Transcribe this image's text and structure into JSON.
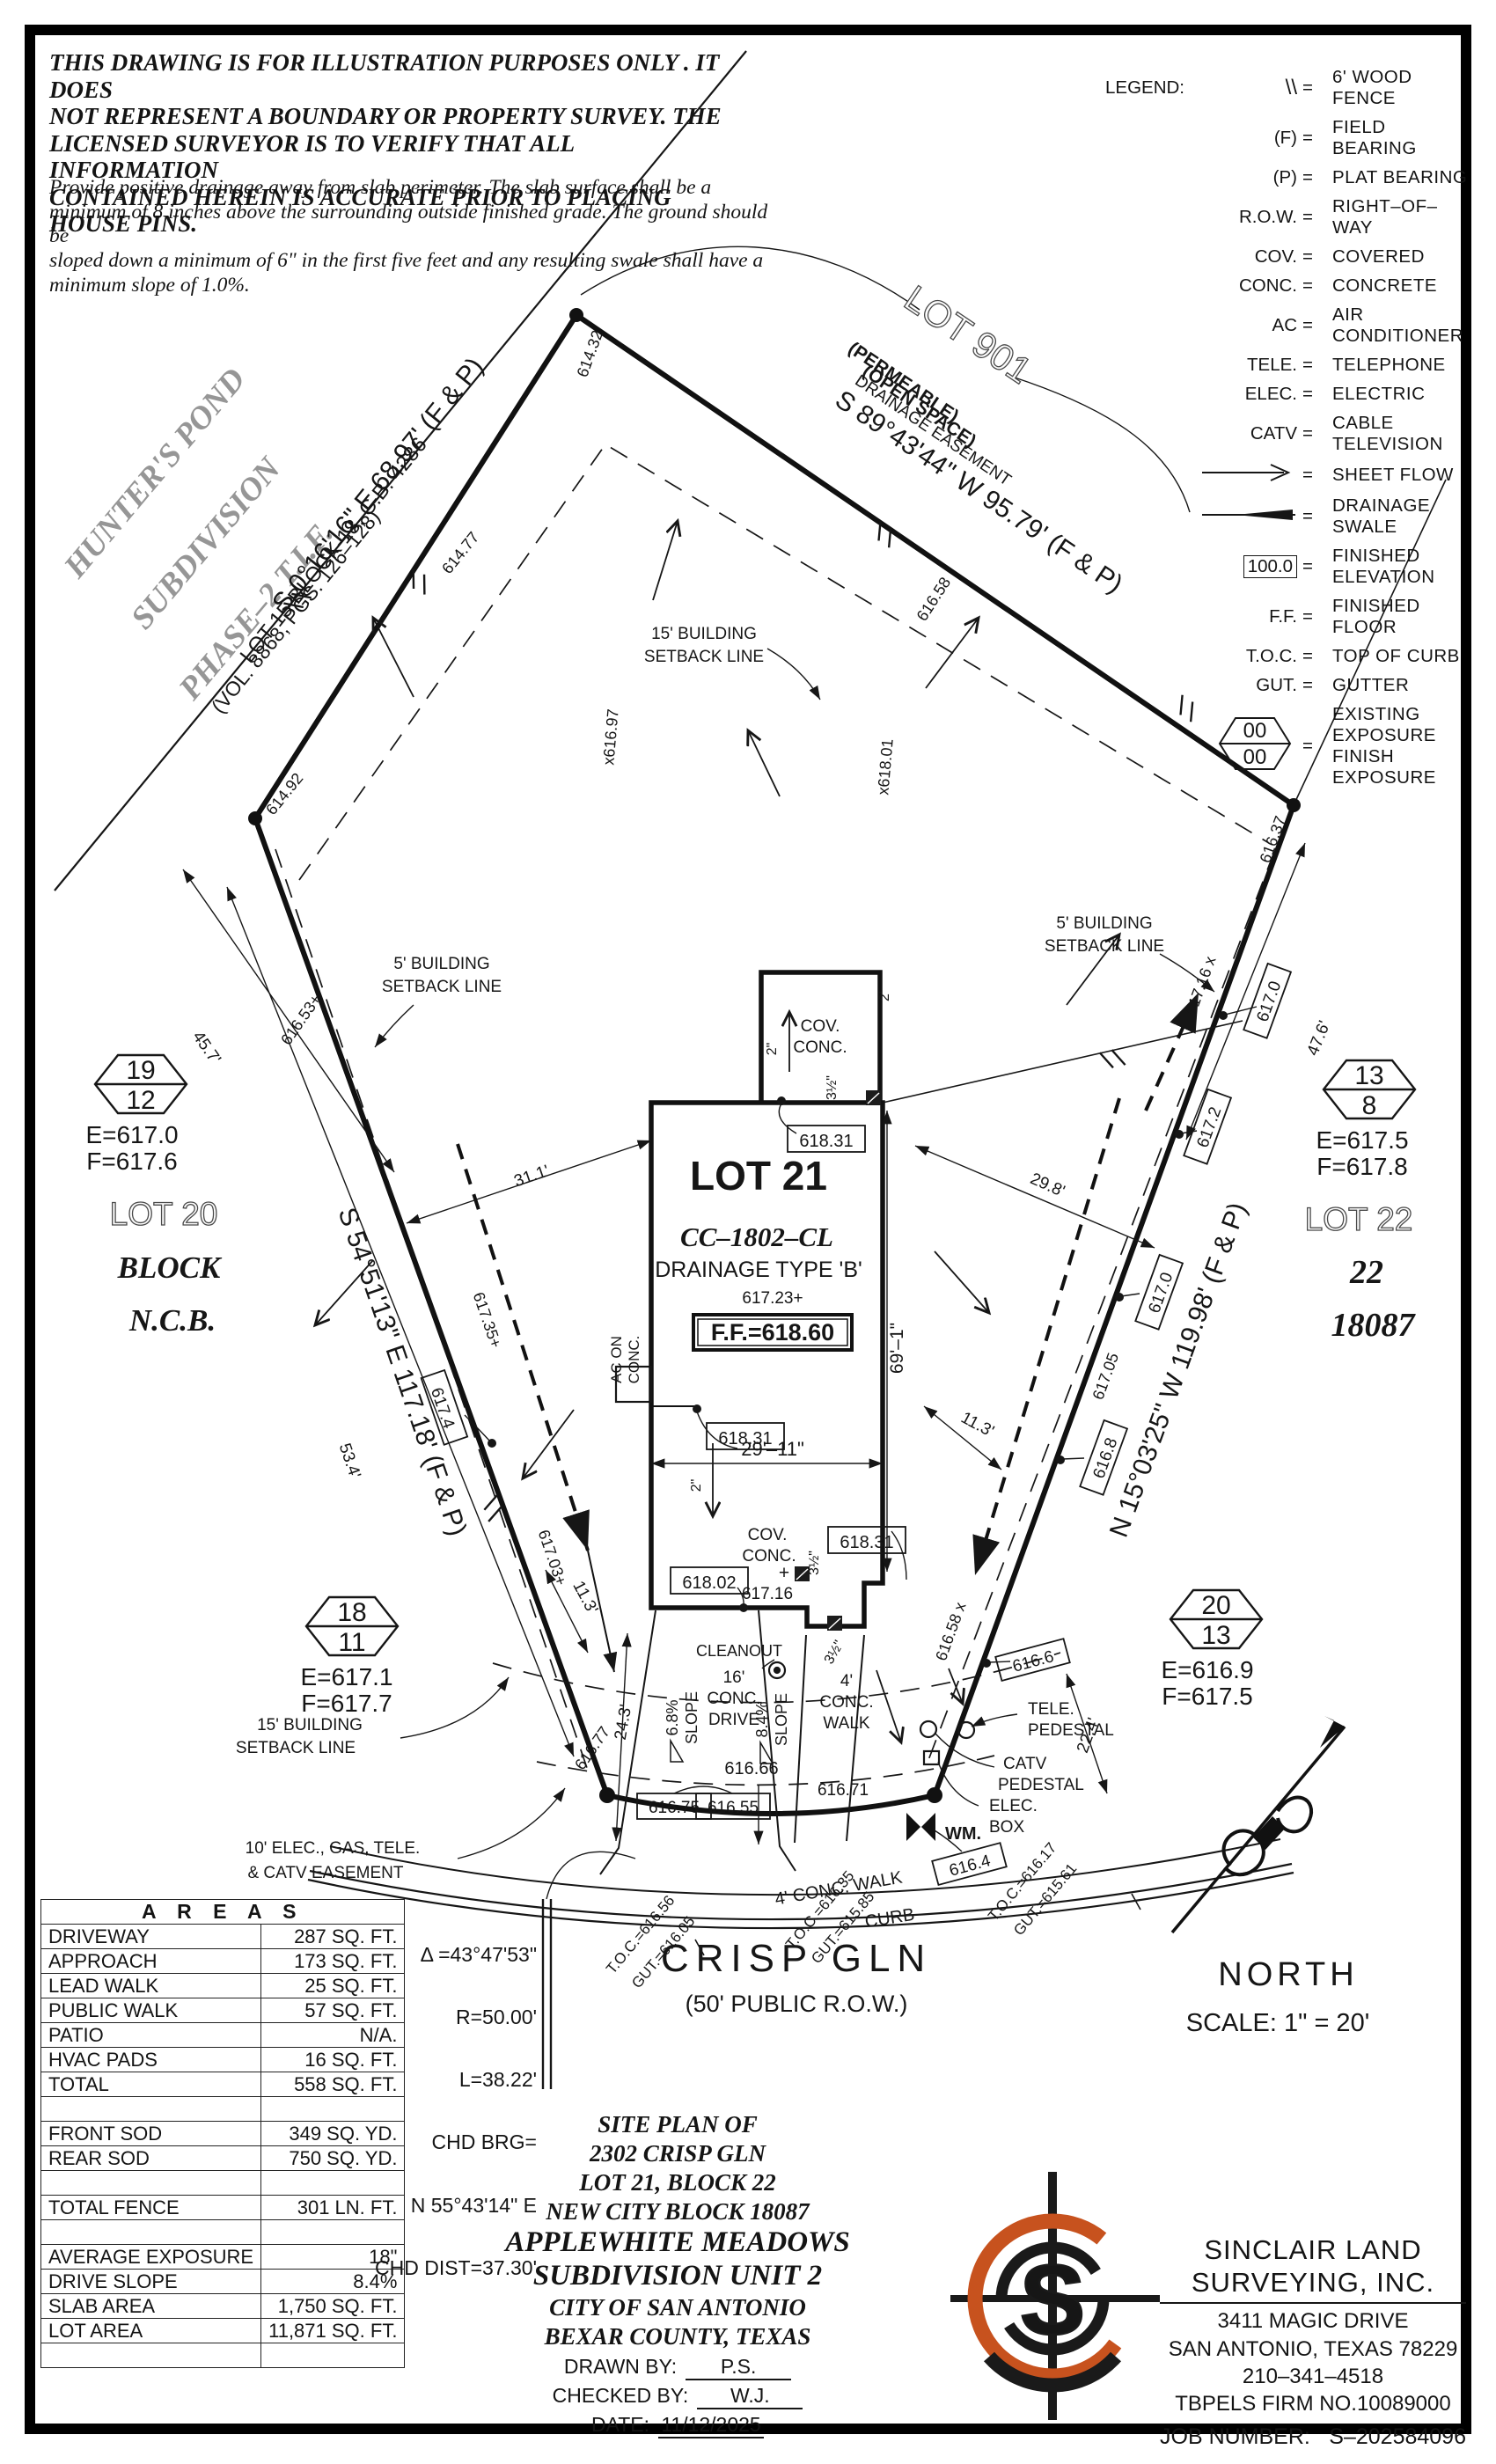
{
  "disclaimer": {
    "p1": "THIS DRAWING IS FOR ILLUSTRATION PURPOSES ONLY . IT DOES\nNOT REPRESENT A BOUNDARY OR PROPERTY SURVEY. THE\nLICENSED SURVEYOR IS TO VERIFY THAT ALL INFORMATION\nCONTAINED HEREIN IS ACCURATE PRIOR TO PLACING HOUSE PINS.",
    "p2": "Provide positive drainage away from slab perimeter. The slab surface shall be a\nminimum of 8 inches above the surrounding outside finished grade. The ground should be\nsloped down a minimum of 6\" in the first five feet and any resulting swale shall have a\nminimum slope of 1.0%."
  },
  "legend": {
    "title": "LEGEND:",
    "eq": "=",
    "fence_sym": "\\\\",
    "fence": "6' WOOD FENCE",
    "f_sym": "(F)",
    "f": "FIELD BEARING",
    "p_sym": "(P)",
    "p": "PLAT BEARING",
    "row_sym": "R.O.W.",
    "row": "RIGHT–OF–WAY",
    "cov_sym": "COV.",
    "cov": "COVERED",
    "conc_sym": "CONC.",
    "conc": "CONCRETE",
    "ac_sym": "AC",
    "ac": "AIR CONDITIONER",
    "tele_sym": "TELE.",
    "tele": "TELEPHONE",
    "elec_sym": "ELEC.",
    "elec": "ELECTRIC",
    "catv_sym": "CATV",
    "catv": "CABLE TELEVISION",
    "sheet": "SHEET FLOW",
    "swale": "DRAINAGE SWALE",
    "elev_val": "100.0",
    "elev": "FINISHED ELEVATION",
    "ff_sym": "F.F.",
    "ff": "FINISHED FLOOR",
    "toc_sym": "T.O.C.",
    "toc": "TOP OF CURB",
    "gut_sym": "GUT.",
    "gut": "GUTTER",
    "exp_top": "00",
    "exp_bot": "00",
    "exp1": "EXISTING EXPOSURE",
    "exp2": "FINISH EXPOSURE"
  },
  "survey": {
    "adjacent": {
      "hp1": "HUNTER'S POND",
      "hp2": "SUBDIVISION",
      "hp3": "PHASE–2 T.I.F.",
      "vol": "(VOL. 8868, PGS. 126–128)",
      "lot15": "LOT 15 BLOCK 18, C.B. 4286"
    },
    "lot901": {
      "name": "LOT 901",
      "permeable": "(PERMEABLE)",
      "open": "(OPEN SPACE)",
      "drain": "DRAINAGE EASEMENT"
    },
    "bearings": {
      "tl": "S 0°16'16\" E 68.97' (F & P)",
      "tr": "S 89°43'44\" W 95.79' (F & P)",
      "left": "S 54°51'13\" E 117.18' (F & P)",
      "right": "N 15°03'25\" W 119.98' (F & P)"
    },
    "lots": {
      "lot20": "LOT 20",
      "block": "BLOCK",
      "ncb": "N.C.B.",
      "lot21": "LOT 21",
      "cc": "CC–1802–CL",
      "dtype": "DRAINAGE TYPE 'B'",
      "pad": "617.23+",
      "ff": "F.F.=618.60",
      "lot22": "LOT 22",
      "n22": "22",
      "nblock": "18087"
    },
    "hexes": [
      {
        "t": "19",
        "b": "12",
        "e": "E=617.0",
        "f": "F=617.6"
      },
      {
        "t": "18",
        "b": "11",
        "e": "E=617.1",
        "f": "F=617.7"
      },
      {
        "t": "13",
        "b": "8",
        "e": "E=617.5",
        "f": "F=617.8"
      },
      {
        "t": "20",
        "b": "13",
        "e": "E=616.9",
        "f": "F=617.5"
      }
    ],
    "setback": {
      "l15a": "15' BUILDING",
      "l15b": "SETBACK LINE",
      "l5a": "5' BUILDING",
      "l5b": "SETBACK LINE"
    },
    "easement": {
      "l1": "10' ELEC., GAS, TELE.",
      "l2": "& CATV EASEMENT"
    },
    "spots": {
      "v1": "614.32",
      "v2": "614.92",
      "v3": "616.37",
      "v4": "616.77",
      "v5": "616.71",
      "e614_77": "614.77",
      "e616_53": "616.53+",
      "e616_58t": "616.58",
      "e616_97": "x616.97",
      "e618_01": "x618.01",
      "e617_35": "617.35+",
      "e617_03": "617.03+",
      "e617_16x": "617.16 x",
      "e617_05": "617.05",
      "e616_58b": "616.58 x",
      "e616_66": "616.66"
    },
    "boxed": {
      "e618_31": "618.31",
      "e618_02": "618.02",
      "e617_4": "617.4",
      "e617_0": "617.0",
      "e617_2": "617.2",
      "e616_8": "616.8",
      "e616_6": "616.6",
      "e616_4": "616.4",
      "e616_75": "616.75",
      "e616_55": "616.55"
    },
    "covconc": {
      "cov": "COV.",
      "conc": "CONC.",
      "plus": "+",
      "e617_16": "617.16"
    },
    "ac": {
      "l1": "AC ON",
      "l2": "CONC."
    },
    "dims": {
      "d31": "31.1'",
      "d29_8": "29.8'",
      "d45": "45.7'",
      "d47": "47.6'",
      "d53": "53.4'",
      "d24": "24.3'",
      "d22": "22.4'",
      "d11": "11.3'",
      "d69": "69'–1\"",
      "d29_11": "29'–11\"",
      "d2in": "2\"",
      "d2ft": "2'",
      "d35": "3½\"",
      "drive1": "16'",
      "drive2": "CONC.",
      "drive3": "DRIVE",
      "s68": "6.8%",
      "s84": "8.4%",
      "slope": "SLOPE",
      "walk1": "4'",
      "walk2": "CONC.",
      "walk3": "WALK",
      "walkline": "4' CONC. WALK",
      "curb": "CURB"
    },
    "util": {
      "cleanout": "CLEANOUT",
      "tele": "TELE.",
      "ped": "PEDESTAL",
      "catv": "CATV",
      "elec": "ELEC.",
      "box": "BOX",
      "wm": "WM."
    },
    "toc": {
      "t1a": "T.O.C.=616.56",
      "t1b": "GUT.=616.05",
      "t2a": "T.O.C.=616.35",
      "t2b": "GUT.=615.85",
      "t3a": "T.O.C.=616.17",
      "t3b": "GUT.=615.61"
    },
    "street": {
      "name": "CRISP GLN",
      "row": "(50' PUBLIC R.O.W.)"
    },
    "north": {
      "label": "NORTH",
      "scale": "SCALE: 1\" = 20'"
    }
  },
  "curve": {
    "lines": [
      "Δ =43°47'53\"",
      "R=50.00'",
      "L=38.22'",
      "CHD BRG=",
      "N 55°43'14\" E",
      "CHD DIST=37.30'"
    ]
  },
  "areas": {
    "title": "A R E A S",
    "rows": [
      {
        "l": "DRIVEWAY",
        "v": "287 SQ. FT."
      },
      {
        "l": "APPROACH",
        "v": "173 SQ. FT."
      },
      {
        "l": "LEAD WALK",
        "v": "25 SQ. FT."
      },
      {
        "l": "PUBLIC WALK",
        "v": "57 SQ. FT."
      },
      {
        "l": "PATIO",
        "v": "N/A."
      },
      {
        "l": "HVAC PADS",
        "v": "16 SQ. FT."
      },
      {
        "l": "TOTAL",
        "v": "558 SQ. FT."
      },
      {
        "l": "",
        "v": ""
      },
      {
        "l": "FRONT SOD",
        "v": "349 SQ. YD."
      },
      {
        "l": "REAR SOD",
        "v": "750 SQ. YD."
      },
      {
        "l": "",
        "v": ""
      },
      {
        "l": "TOTAL FENCE",
        "v": "301 LN. FT."
      },
      {
        "l": "",
        "v": ""
      },
      {
        "l": "AVERAGE EXPOSURE",
        "v": "18\""
      },
      {
        "l": "DRIVE SLOPE",
        "v": "8.4%"
      },
      {
        "l": "SLAB AREA",
        "v": "1,750 SQ. FT."
      },
      {
        "l": "LOT AREA",
        "v": "11,871 SQ. FT."
      },
      {
        "l": "",
        "v": ""
      }
    ]
  },
  "titleblock": {
    "l1": "SITE PLAN OF",
    "l2": "2302 CRISP GLN",
    "l3": "LOT 21, BLOCK 22",
    "l4": "NEW CITY BLOCK 18087",
    "l5": "APPLEWHITE MEADOWS",
    "l6": "SUBDIVISION UNIT 2",
    "l7": "CITY OF SAN ANTONIO",
    "l8": "BEXAR COUNTY, TEXAS",
    "drawn_label": "DRAWN BY:",
    "drawn_value": "P.S.",
    "checked_label": "CHECKED BY:",
    "checked_value": "W.J.",
    "date_label": "DATE:",
    "date_value": "11/12/2025"
  },
  "firm": {
    "n1": "SINCLAIR LAND",
    "n2": "SURVEYING, INC.",
    "a1": "3411 MAGIC DRIVE",
    "a2": "SAN ANTONIO, TEXAS 78229",
    "phone": "210–341–4518",
    "tbpels": "TBPELS FIRM NO.10089000",
    "job_label": "JOB NUMBER:",
    "job_value": "S–202584096",
    "logo_letter": "S",
    "accent": "#c7521e"
  }
}
